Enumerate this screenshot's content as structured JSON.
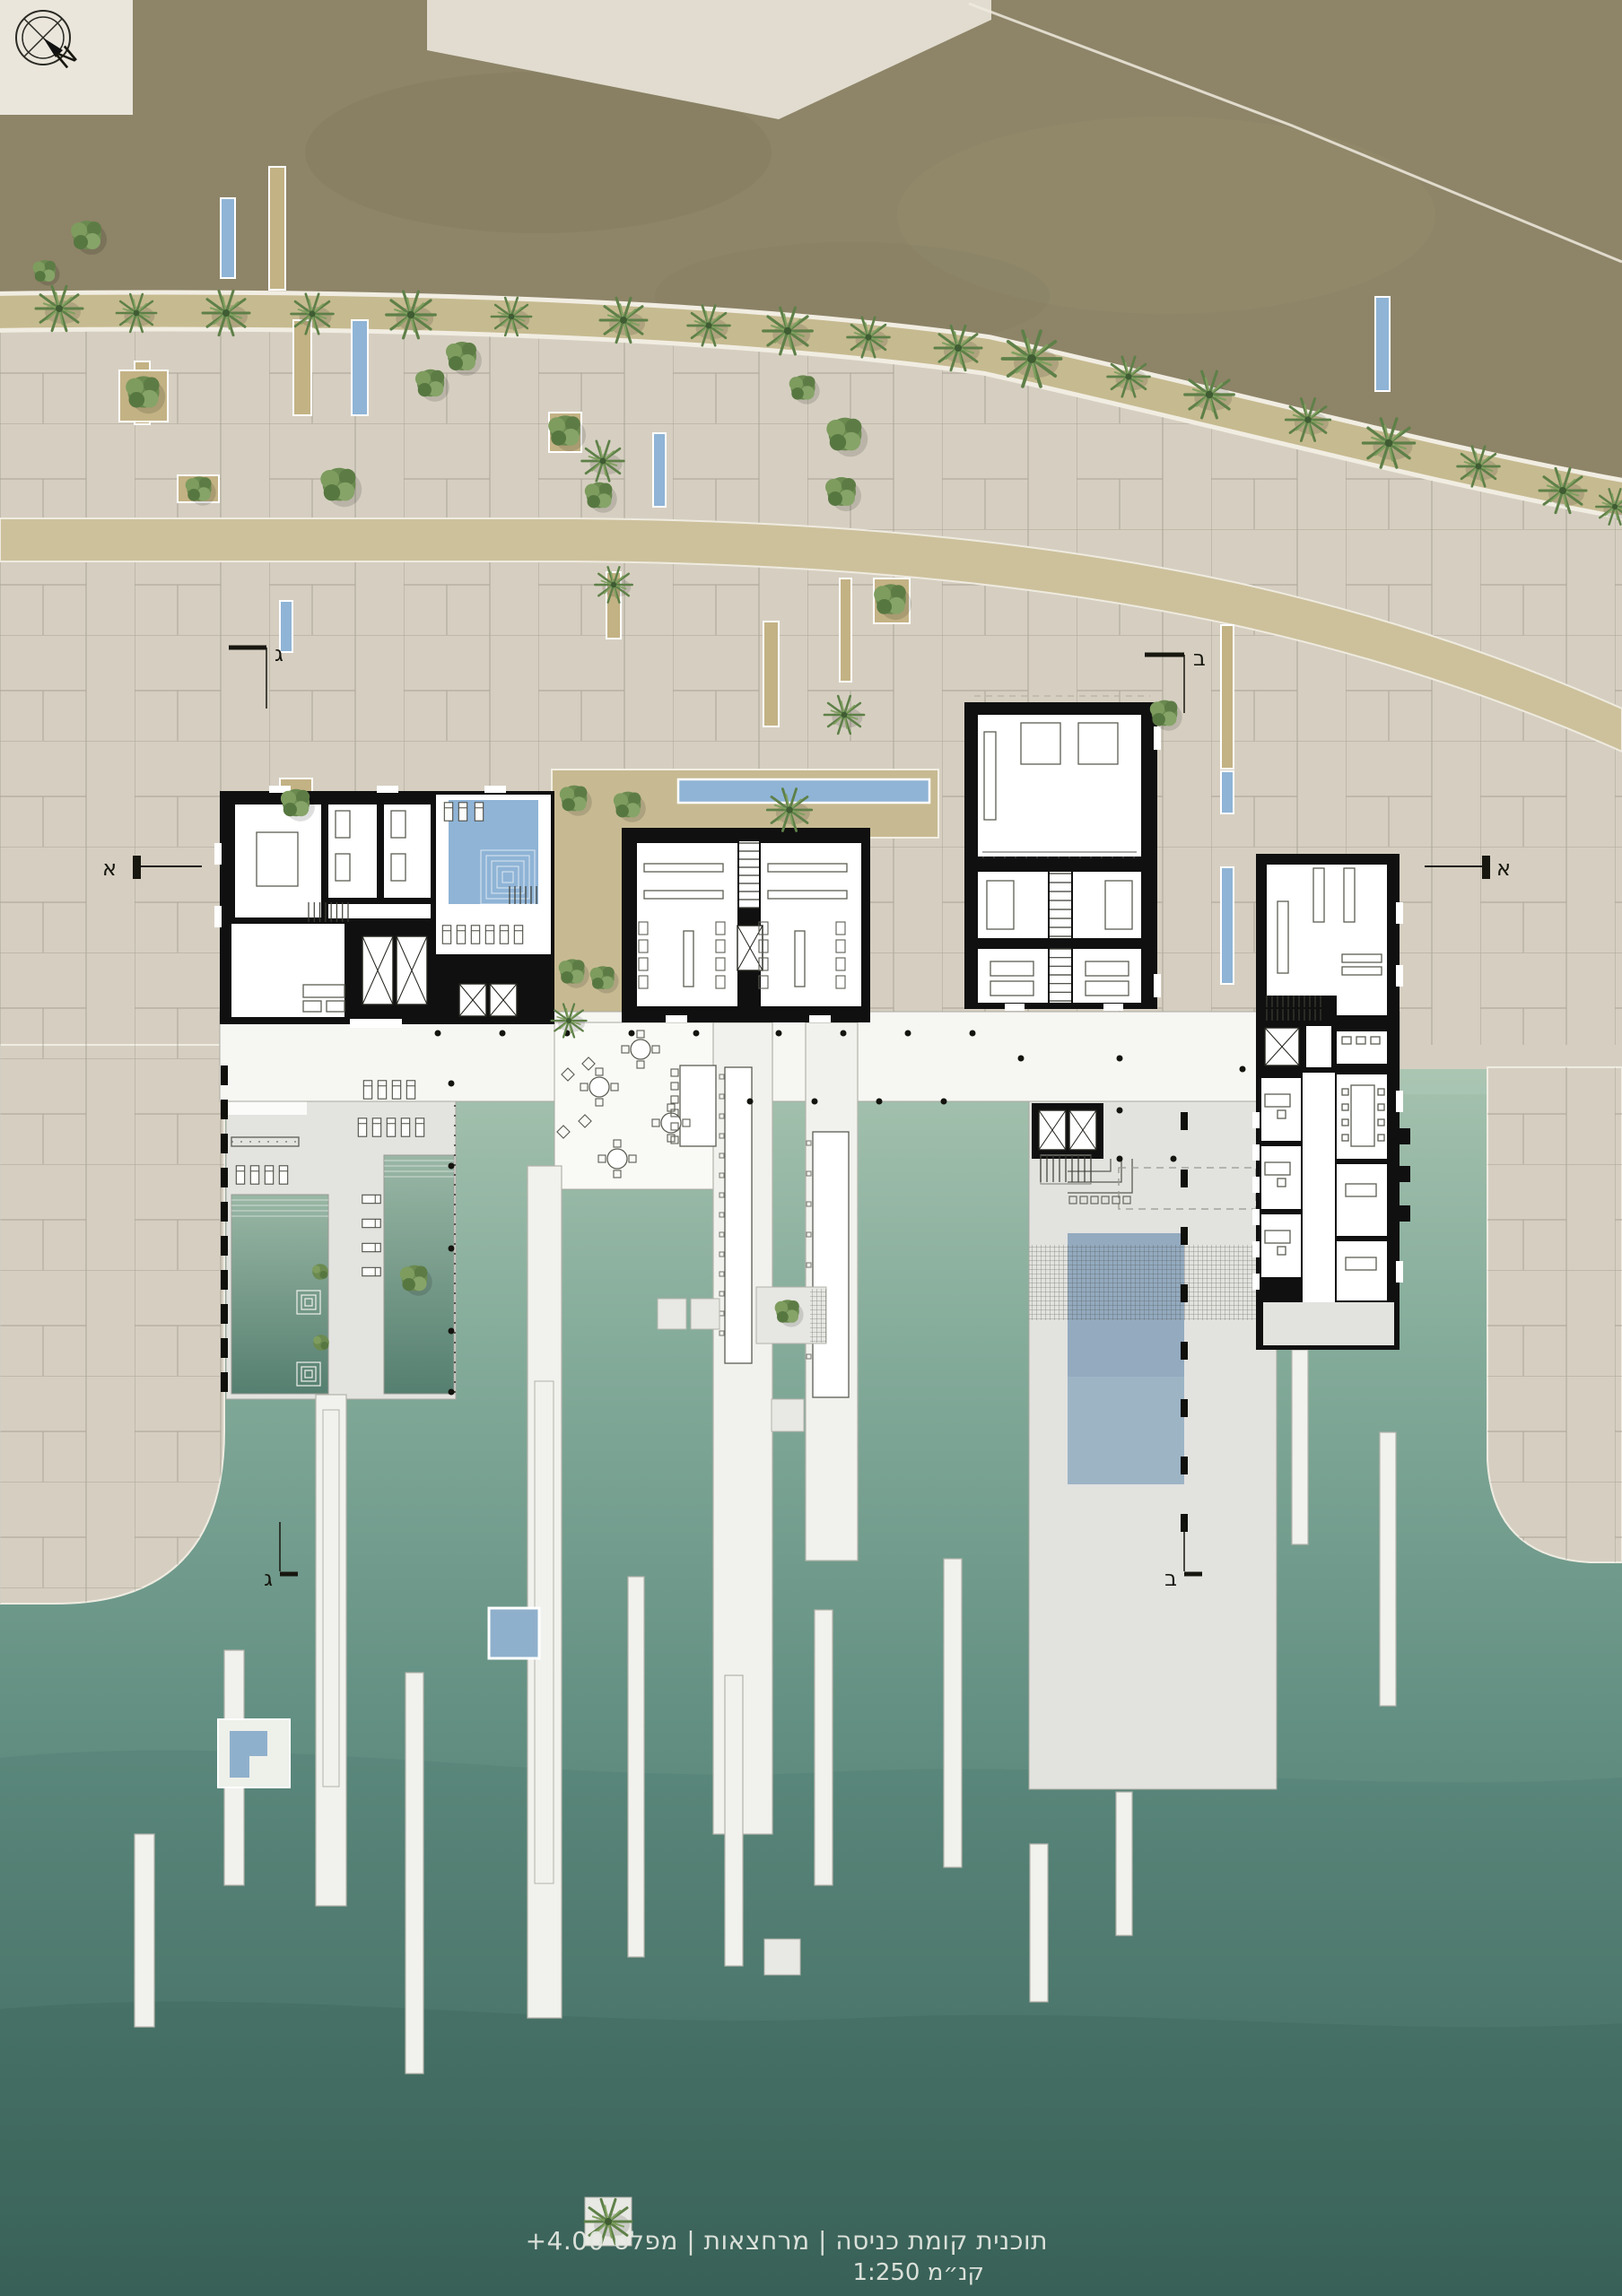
{
  "plan": {
    "title_text": "תוכנית קומת כניסה | מרחצאות | מפלס",
    "title_level": "+4.00",
    "scale_prefix": "קנ״מ",
    "scale_value": "1:250"
  },
  "north_arrow": {
    "label": "N"
  },
  "section_markers": {
    "aleph_left": {
      "label": "א"
    },
    "aleph_right": {
      "label": "א"
    },
    "bet_top": {
      "label": "ב"
    },
    "bet_bottom": {
      "label": "ב"
    },
    "gimel_top": {
      "label": "ג"
    },
    "gimel_bottom": {
      "label": "ג"
    }
  },
  "palette": {
    "sea_top": "#a9c5b1",
    "sea_bottom": "#41695f",
    "plaza_stone": "#d6cfc1",
    "terrain_brown": "#8e8468",
    "path_sand": "#cdc19c",
    "planter_sand": "#c3b284",
    "water_feature_blue": "#8fb4d6",
    "sea_pool_green": "#6d9486",
    "pergola_pool_blue": "#93aabf",
    "deck_white": "#f4f4f0",
    "deck_gray": "#e2e2df",
    "building_wall": "#101010",
    "tree_green": "#6d8c52"
  }
}
